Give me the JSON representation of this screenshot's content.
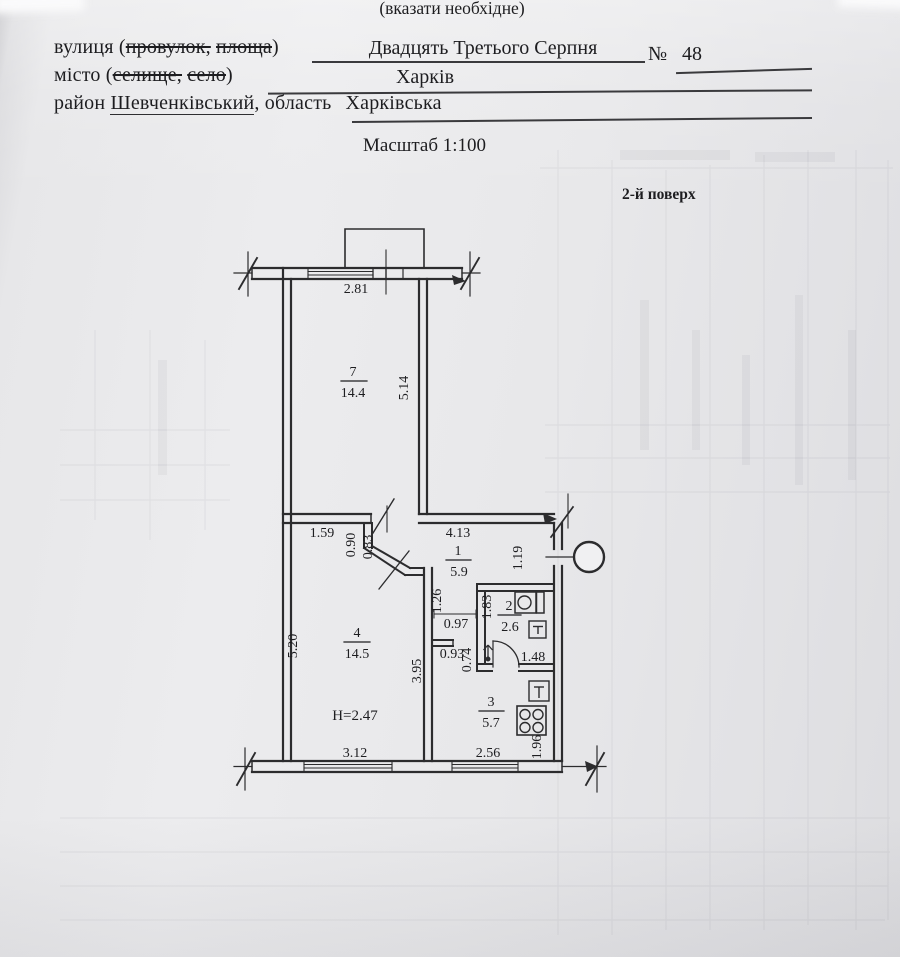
{
  "document": {
    "note_top": "(вказати необхідне)",
    "street_label_open": "вулиця (",
    "street_struck_1": "провулок,",
    "street_struck_2": "площа",
    "street_label_close": ")",
    "street_value": "Двадцять Третього Серпня",
    "number_sign": "№",
    "house_number": "48",
    "city_label_open": "місто (",
    "city_struck_1": "селище,",
    "city_struck_2": "село",
    "city_label_close": ")",
    "city_value": "Харків",
    "district_label": "район ",
    "district_value": "Шевченківський",
    "region_label": ", область",
    "region_value": "Харківська",
    "scale_note": "Масштаб 1:100",
    "floor_note": "2-й поверх"
  },
  "plan": {
    "rooms": {
      "room7": {
        "num": "7",
        "area": "14.4"
      },
      "room1": {
        "num": "1",
        "area": "5.9"
      },
      "room2": {
        "num": "2",
        "area": "2.6"
      },
      "room3": {
        "num": "3",
        "area": "5.7"
      },
      "room4": {
        "num": "4",
        "area": "14.5"
      }
    },
    "dims": {
      "d281": "2.81",
      "d514": "5.14",
      "d159": "1.59",
      "d090": "0.90",
      "d083": "0.83",
      "d413": "4.13",
      "d119": "1.19",
      "d126": "1.26",
      "d183": "1.83",
      "d097": "0.97",
      "d093": "0.93",
      "d074": "0.74",
      "d148": "1.48",
      "d520": "5.20",
      "d395": "3.95",
      "d196": "1.96",
      "d312": "3.12",
      "d256": "2.56",
      "height": "H=2.47"
    },
    "colors": {
      "ink": "#2c2c2e",
      "paper": "#e8e8ea"
    }
  }
}
